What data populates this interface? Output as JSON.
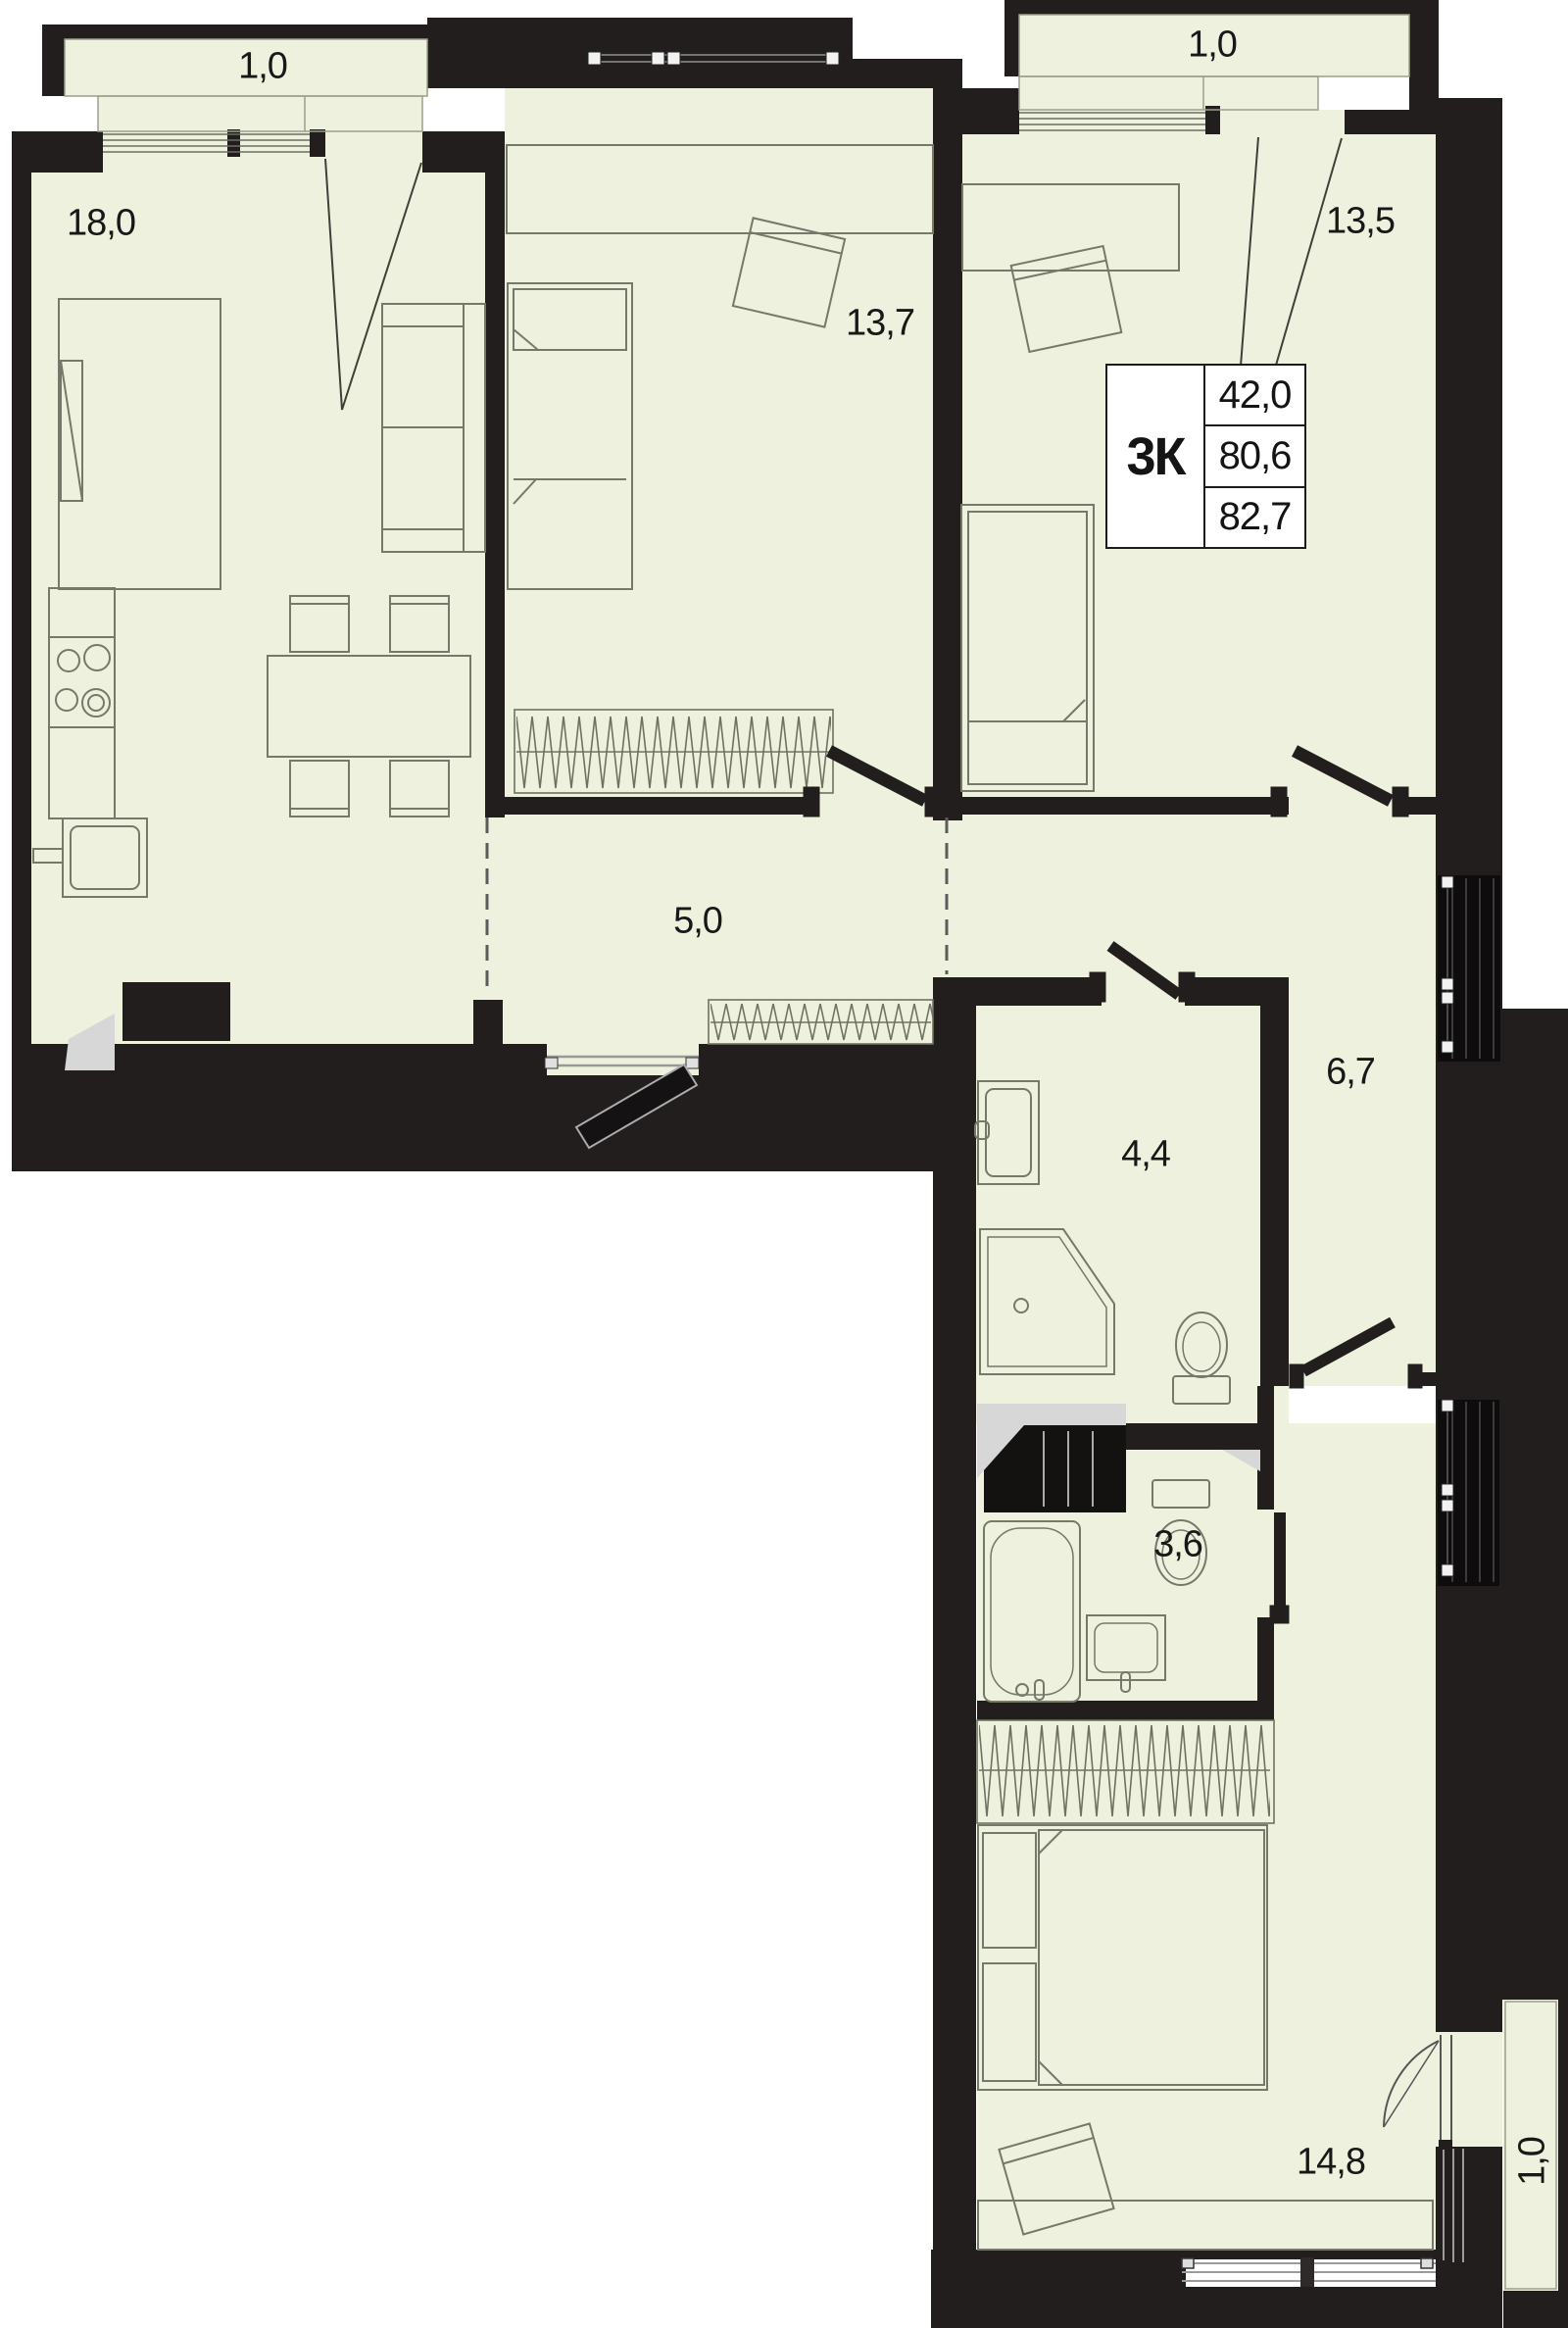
{
  "title": "3-room apartment floor plan",
  "info_box": {
    "type_label": "3К",
    "living_area": "42,0",
    "apartment_area": "80,6",
    "total_area": "82,7"
  },
  "rooms": [
    {
      "id": "kitchen-living-room",
      "area_label": "18,0"
    },
    {
      "id": "bedroom-middle",
      "area_label": "13,7"
    },
    {
      "id": "bedroom-right",
      "area_label": "13,5"
    },
    {
      "id": "hallway",
      "area_label": "5,0"
    },
    {
      "id": "inner-corridor",
      "area_label": "6,7"
    },
    {
      "id": "shower-room",
      "area_label": "4,4"
    },
    {
      "id": "bathroom",
      "area_label": "3,6"
    },
    {
      "id": "bedroom-bottom",
      "area_label": "14,8"
    }
  ],
  "balconies": [
    {
      "id": "balcony-top-left",
      "area_label": "1,0"
    },
    {
      "id": "balcony-top-right",
      "area_label": "1,0"
    },
    {
      "id": "balcony-bottom-right",
      "area_label": "1,0"
    }
  ],
  "colors": {
    "floor": "#edf1dd",
    "walls": "#221e1e",
    "outside": "#000000",
    "furniture_line": "#75796a"
  }
}
